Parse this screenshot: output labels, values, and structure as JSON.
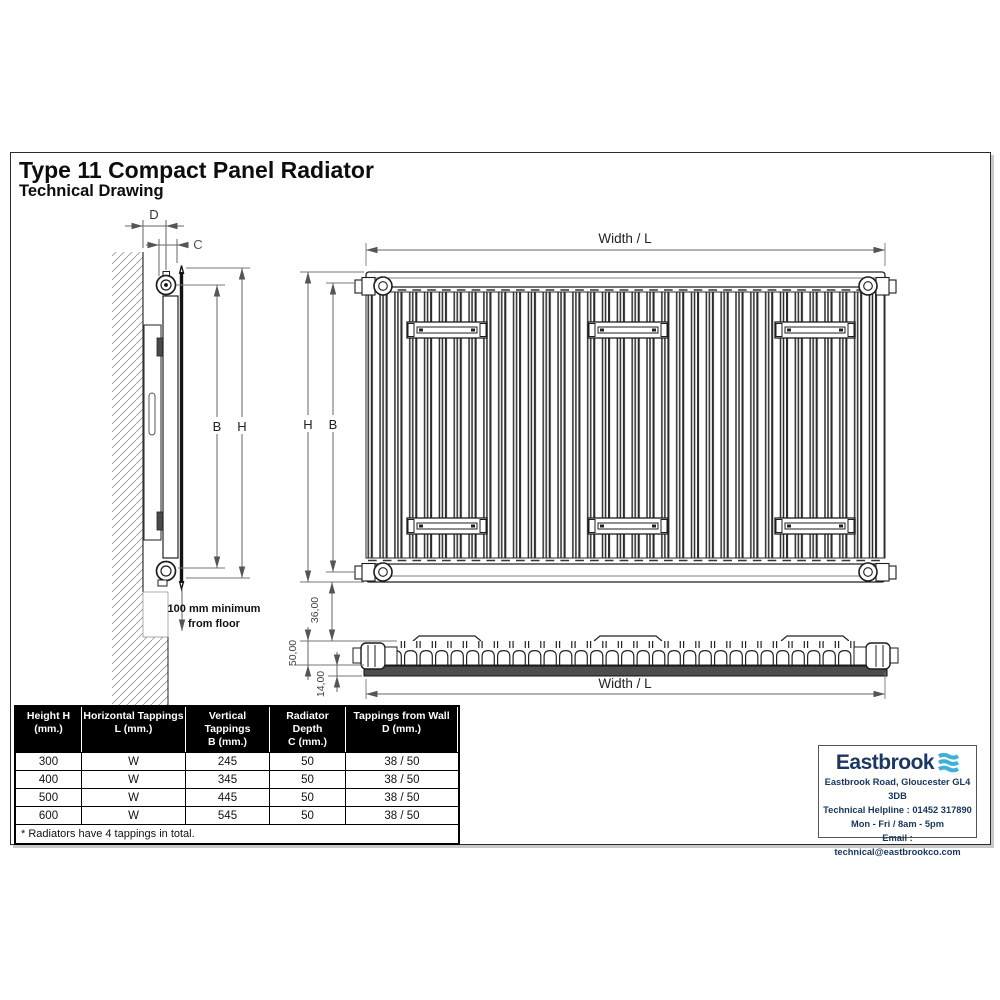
{
  "header": {
    "title": "Type 11 Compact Panel Radiator",
    "subtitle": "Technical Drawing"
  },
  "side_view": {
    "dim_d": "D",
    "dim_c": "C",
    "dim_b": "B",
    "dim_h": "H",
    "floor_note_1": "100 mm minimum",
    "floor_note_2": "from floor"
  },
  "front_view": {
    "width_label": "Width / L",
    "dim_h": "H",
    "dim_b": "B"
  },
  "profile_view": {
    "width_label": "Width / L",
    "dim_36": "36,00",
    "dim_50": "50,00",
    "dim_14": "14,00"
  },
  "table": {
    "headers": [
      "Height H\n(mm.)",
      "Horizontal Tappings\nL (mm.)",
      "Vertical Tappings\nB (mm.)",
      "Radiator Depth\nC (mm.)",
      "Tappings from Wall\nD (mm.)"
    ],
    "rows": [
      [
        "300",
        "W",
        "245",
        "50",
        "38 / 50"
      ],
      [
        "400",
        "W",
        "345",
        "50",
        "38 / 50"
      ],
      [
        "500",
        "W",
        "445",
        "50",
        "38 / 50"
      ],
      [
        "600",
        "W",
        "545",
        "50",
        "38 / 50"
      ]
    ],
    "footnote": "* Radiators have 4 tappings in total."
  },
  "brand": {
    "name": "Eastbrook",
    "address": "Eastbrook Road, Gloucester GL4 3DB",
    "helpline": "Technical Helpline : 01452 317890",
    "hours": "Mon - Fri / 8am - 5pm",
    "email": "Email : technical@eastbrookco.com",
    "colors": {
      "navy": "#1c3764",
      "cyan": "#3fb0d9"
    }
  }
}
